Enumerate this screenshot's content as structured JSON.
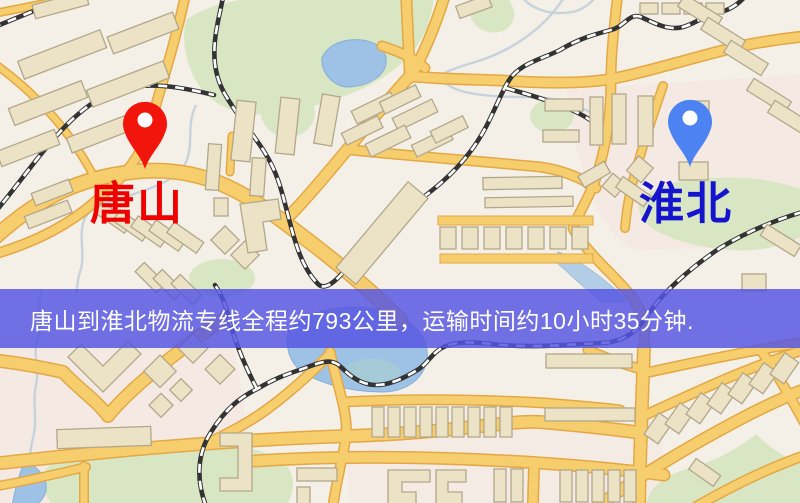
{
  "banner": {
    "text": "唐山到淮北物流专线全程约793公里，运输时间约10小时35分钟.",
    "background": "rgba(86,86,226,0.84)",
    "text_color": "#ffffff"
  },
  "route": {
    "origin": "唐山",
    "destination": "淮北",
    "service": "物流专线",
    "distance_km": "793",
    "duration_hours": "10",
    "duration_minutes": "35"
  },
  "markers": [
    {
      "id": "origin",
      "city": "唐山",
      "pin_color": "#f2150b",
      "label_color": "#ee0000"
    },
    {
      "id": "destination",
      "city": "淮北",
      "pin_color": "#4c82f2",
      "label_color": "#1414cf"
    }
  ],
  "map_palette": {
    "base": "#f5f0e7",
    "park": "#d9e6c4",
    "water": "#9dc2e6",
    "road_fill": "#f7ce6e",
    "road_casing": "#e3a845",
    "building": "#ece3c7",
    "building_edge": "#b3a78a",
    "railway": "#333333",
    "pink_zone": "#f5e4df"
  }
}
